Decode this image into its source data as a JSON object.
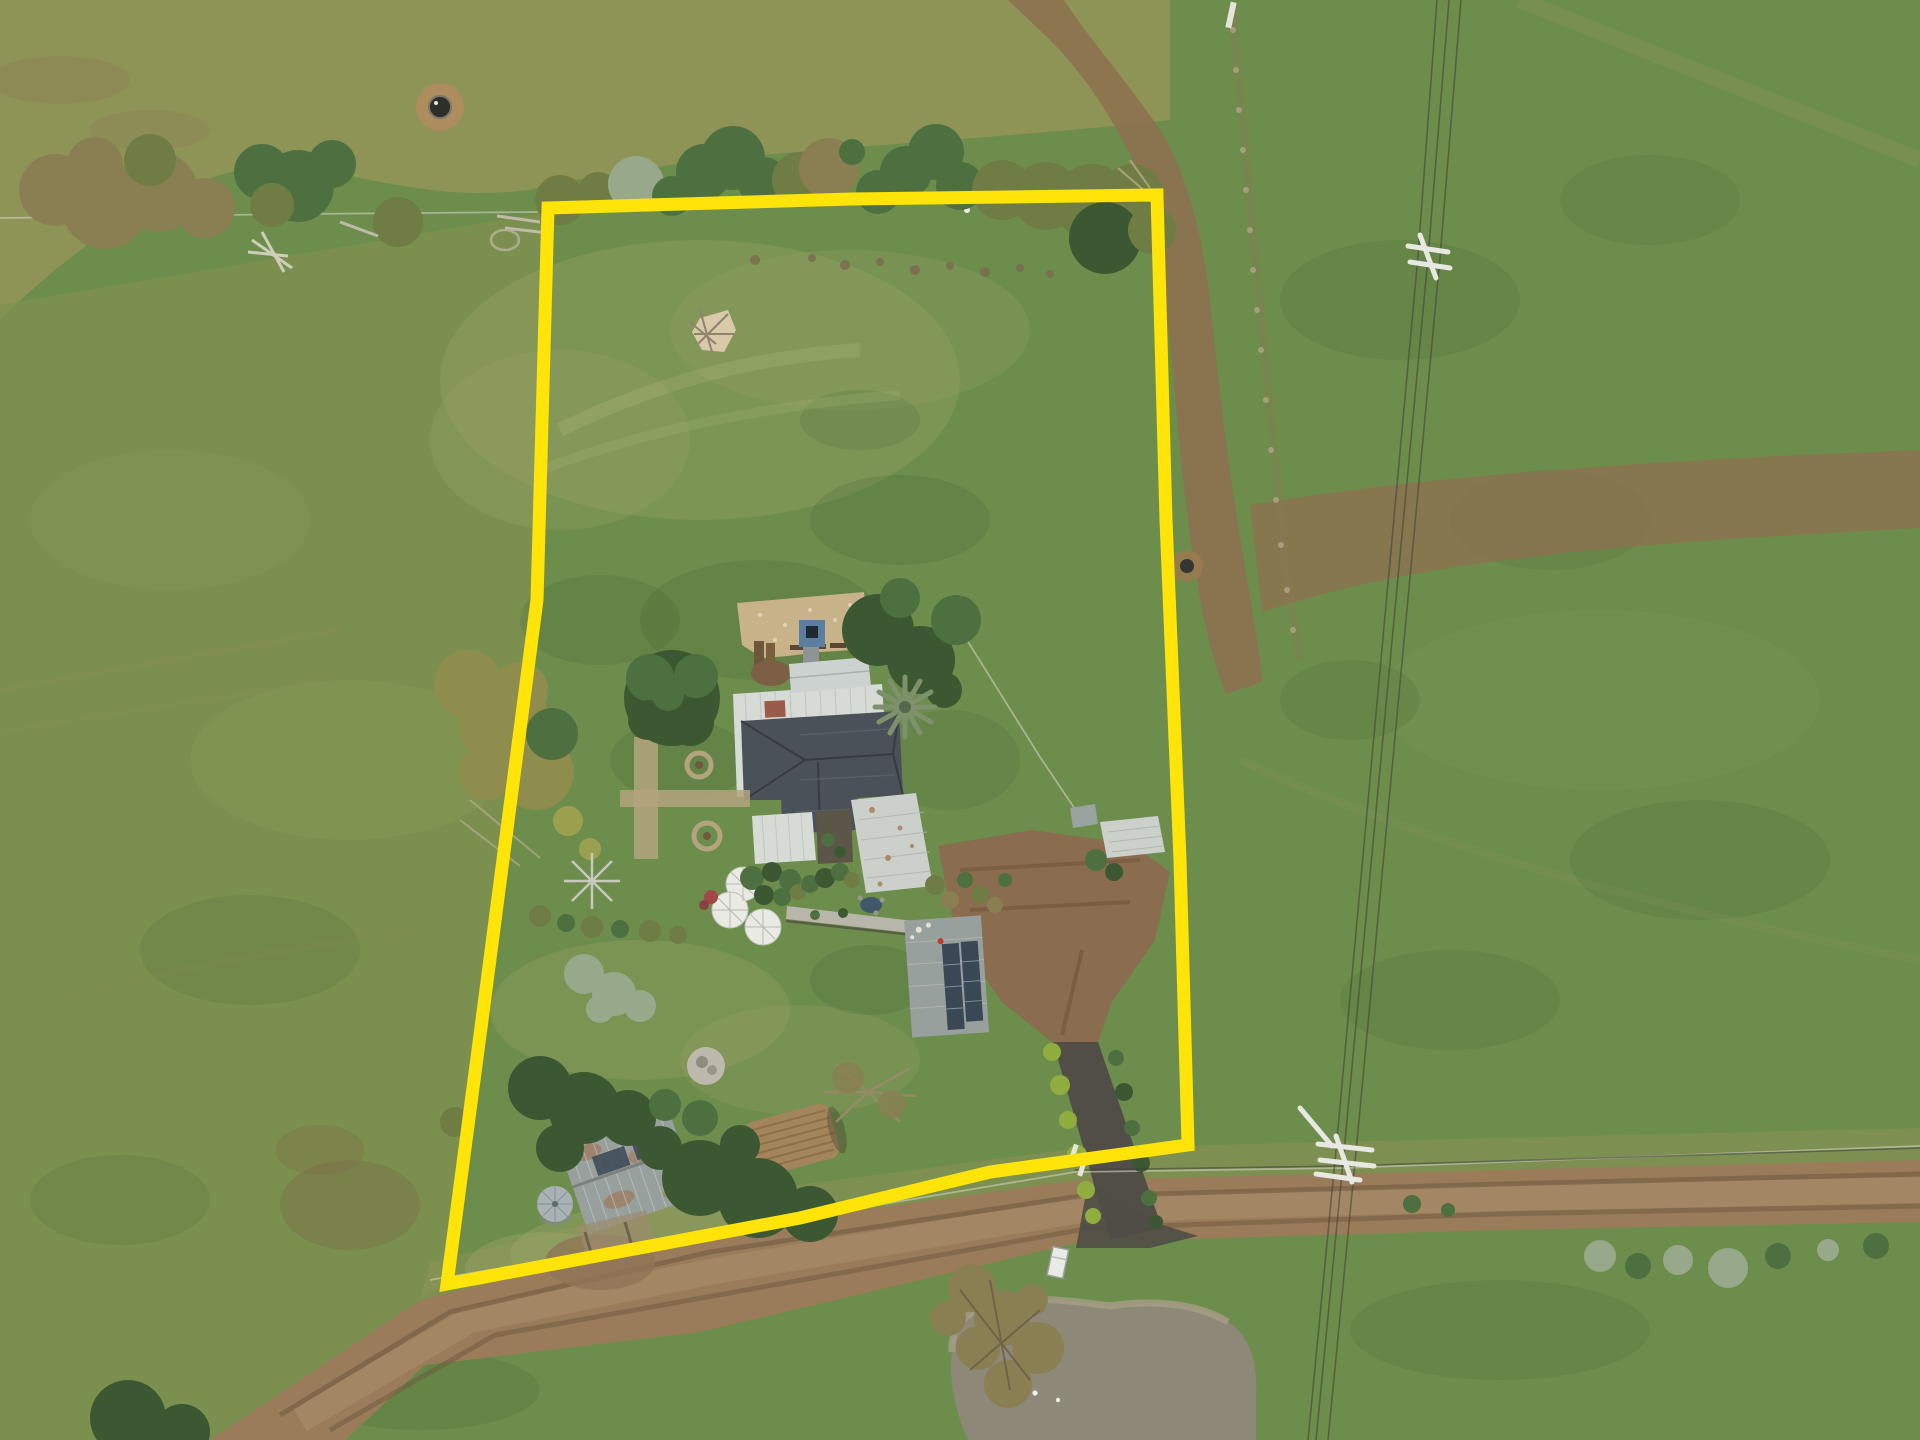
{
  "image": {
    "kind": "aerial-drone-photograph",
    "subject": "rural acreage property with house, sheds, gardens, dam and dirt road, lot outlined in yellow",
    "width_px": 1920,
    "height_px": 1440
  },
  "palette": {
    "boundary_yellow": "#ffe409",
    "grass_base": "#6d8d4c",
    "grass_olive": "#8d9456",
    "grass_paddock": "#80914f",
    "grass_dry": "#9ba468",
    "grass_dark": "#3f5e33",
    "dirt": "#8d7150",
    "dirt_parking": "#8a6c4e",
    "road": "#9b7c5a",
    "road_track": "#6d5740",
    "road_light": "#ab906b",
    "driveway": "#504e46",
    "pond": "#8d8878",
    "pond_rim": "#a89e86",
    "tree_dark": "#3c5832",
    "tree_green": "#4e7040",
    "tree_olive": "#6f7d44",
    "tree_brown": "#8a7f52",
    "tree_sage": "#98a88a",
    "tree_yellow": "#9aa04e",
    "tree_golden": "#8f8d4e",
    "hedge_bright": "#8fae3f",
    "palm": "#7e906c",
    "roof_dark": "#4b5158",
    "roof_ridge": "#343a40",
    "roof_white": "#d7dbd6",
    "roof_annex": "#ccd2cf",
    "roof_ext": "#cbd0ca",
    "shed_metal": "#98a09e",
    "rust": "#a26e48",
    "solar_panel": "#3a4754",
    "tank": "#a9b2b4",
    "courtyard": "#c7b28a",
    "garden_path": "#b3a47e",
    "umbrella": "#e9eae3",
    "blue_tower": "#5a7fa0",
    "wood_pile": "#a3855c",
    "wood_dark": "#8a6a45",
    "ash": "#bdb9ac",
    "wire": "#3c3f38",
    "fence": "#d8d5c8",
    "stone_fence": "#8d7a58",
    "garden_pond": "#41586a",
    "flower_red": "#a04848",
    "van_white": "#e8eae6"
  },
  "boundary": {
    "points": "548,208 852,199 1157,195 1166,520 1180,860 1188,1145 990,1172 800,1218 447,1284 482,1020 537,600",
    "stroke_width": 13
  },
  "road": {
    "path": "M210,1440 L420,1300 L700,1232 L1080,1180 L1500,1170 L1920,1160 L1920,1222 L1500,1230 L1080,1242 L700,1332 L425,1365 L345,1440 Z",
    "centerline": "M300,1420 L470,1320 L720,1270 L1080,1210 L1500,1198 L1920,1190",
    "track_a": "M280,1415 L450,1312 L710,1252 L1080,1196 L1500,1184 L1920,1174",
    "track_b": "M330,1430 L495,1335 L735,1292 L1090,1228 L1500,1214 L1920,1206"
  },
  "driveway": {
    "lane": "M1053,1042 L1098,1042 L1162,1228 L1110,1240 Z",
    "junction": "M1088,1182 L1160,1224 L1198,1236 L1150,1248 L1076,1248 Z",
    "parking": "M938,846 L1032,830 L1132,844 L1170,872 L1155,940 L1112,1002 L1098,1042 L1052,1042 L1002,1002 L956,936 Z"
  },
  "pond": {
    "water": "M952,1352 C950,1322 975,1305 1005,1302 C1040,1296 1080,1302 1110,1306 C1150,1300 1195,1302 1228,1322 C1250,1336 1258,1362 1256,1395 L1256,1440 L968,1440 C955,1410 948,1380 952,1352 Z"
  },
  "farm_track": {
    "north_south": "M1008,0 L1064,0 C1090,40 1130,85 1160,130 C1185,170 1202,230 1210,300 C1218,380 1228,470 1244,560 C1252,610 1260,650 1262,682 L1226,694 C1204,640 1192,560 1182,470 C1174,390 1168,310 1158,240 C1146,170 1100,90 1050,40 Z",
    "east_west": "M1250,505 C1400,480 1600,462 1920,450 L1920,528 C1600,545 1420,560 1262,612 Z"
  },
  "powerline": {
    "wire_1": "M1437,0 L1418,256 L1336,1150 L1308,1440",
    "wire_2": "M1449,0 L1428,258 L1344,1152 L1316,1440",
    "wire_3": "M1461,0 L1440,258 L1356,1152 L1328,1440",
    "cross_span": "M1075,1170 L1344,1166 L1920,1148"
  },
  "fences": {
    "north_paddock": "M0,218 L300,214 L540,212",
    "road_side": "M430,1280 L1075,1172 L1344,1168 L1920,1146",
    "stone_line": "M1232,10 L1262,330 L1285,560 L1300,660",
    "garden_north": "M659,650 688,604 918,587",
    "garden_east": "M942,600 1040,757 1077,812"
  }
}
